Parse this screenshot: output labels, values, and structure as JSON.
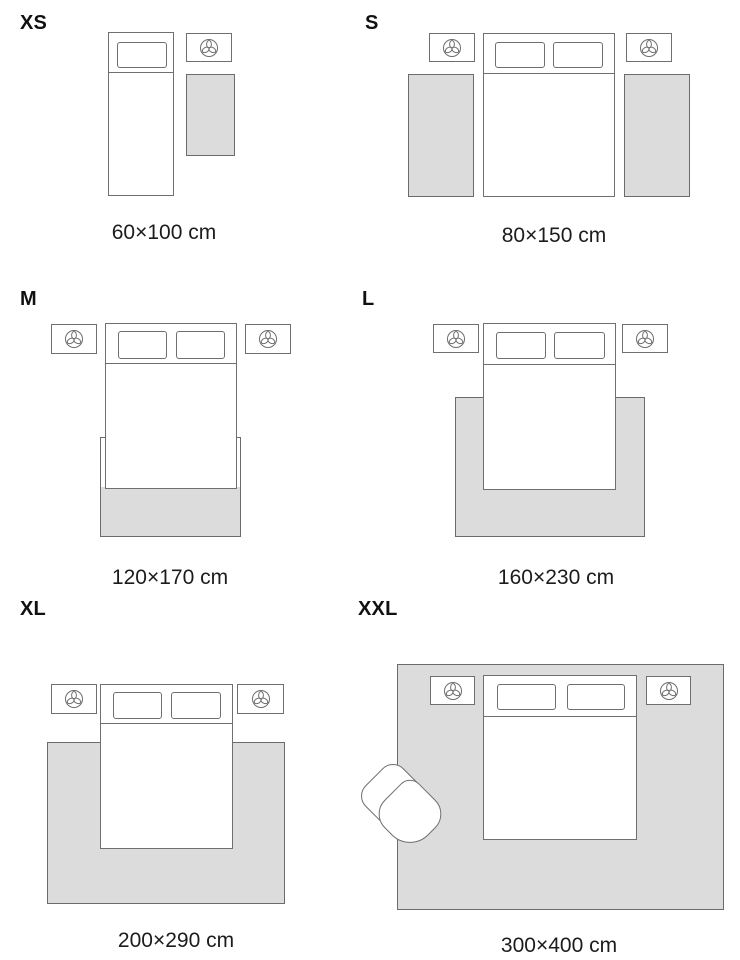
{
  "colors": {
    "background": "#ffffff",
    "outline": "#6f6f6f",
    "rug_fill": "#dcdcdc",
    "rug_border": "#6b6b6b",
    "text": "#1a1a1a"
  },
  "icons": {
    "nightstand_decor": "plant-trefoil-icon"
  },
  "sections": [
    {
      "id": "xs",
      "label": "XS",
      "caption": "60×100 cm",
      "furniture": [
        "single-bed",
        "nightstand",
        "rug"
      ]
    },
    {
      "id": "s",
      "label": "S",
      "caption": "80×150 cm",
      "furniture": [
        "double-bed",
        "nightstand",
        "nightstand",
        "rug",
        "rug"
      ]
    },
    {
      "id": "m",
      "label": "M",
      "caption": "120×170 cm",
      "furniture": [
        "double-bed",
        "nightstand",
        "nightstand",
        "rug"
      ]
    },
    {
      "id": "l",
      "label": "L",
      "caption": "160×230 cm",
      "furniture": [
        "double-bed",
        "nightstand",
        "nightstand",
        "rug"
      ]
    },
    {
      "id": "xl",
      "label": "XL",
      "caption": "200×290 cm",
      "furniture": [
        "double-bed",
        "nightstand",
        "nightstand",
        "rug"
      ]
    },
    {
      "id": "xxl",
      "label": "XXL",
      "caption": "300×400 cm",
      "furniture": [
        "double-bed",
        "nightstand",
        "nightstand",
        "rug",
        "armchair"
      ]
    }
  ]
}
